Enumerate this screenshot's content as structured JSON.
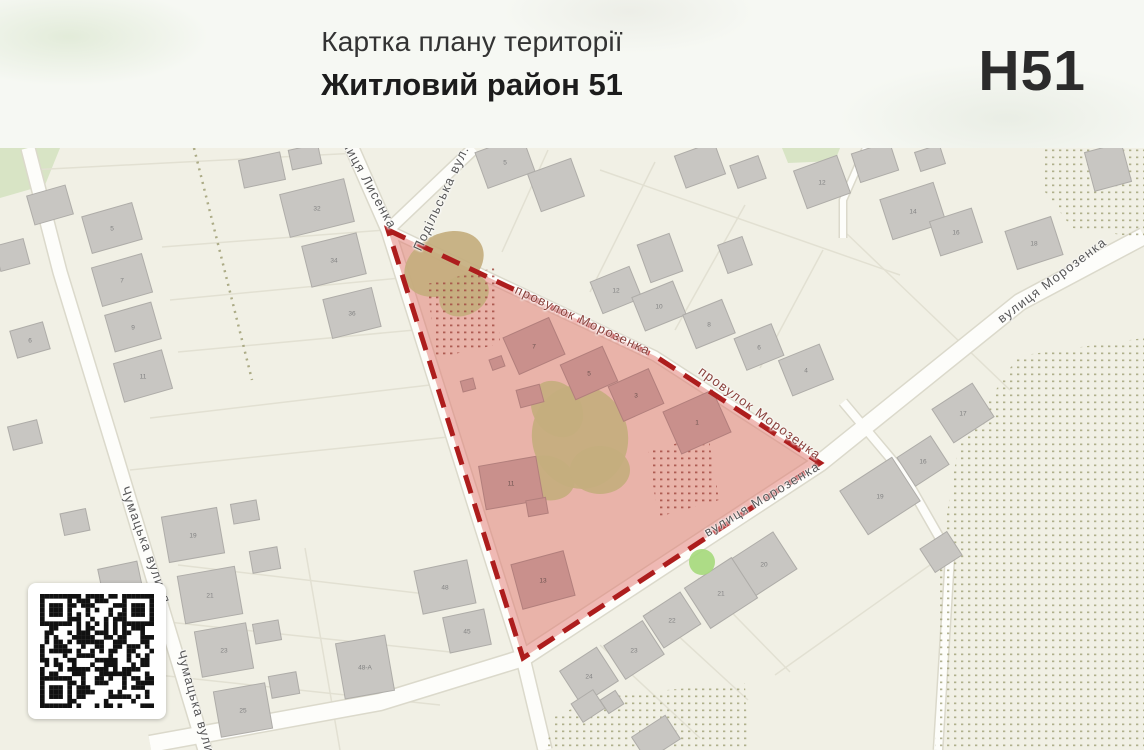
{
  "header": {
    "title": "Картка плану території",
    "subtitle": "Житловий район 51",
    "code": "Н51"
  },
  "colors": {
    "map_bg": "#f1f0e5",
    "green": "#cfe0ba",
    "parcel": "#e2e0d2",
    "road": "#fdfdfa",
    "road_casing": "#dbd9cb",
    "orchard_dot": "#9b9b6f",
    "zone_dot": "#a34c44",
    "building": "#c8c6c2",
    "building_border": "#aeaca8",
    "building_label": "#828282",
    "zone_building": "#c9908c",
    "zone_building_border": "#b27f7c",
    "zone_building_label": "#6e5350",
    "veg": "#c4ae7e",
    "tree": "#a5d97b"
  },
  "map": {
    "streets": [
      {
        "name": "вулиця Лисенка",
        "x": 366,
        "y": 178,
        "rot": 61,
        "red": false
      },
      {
        "name": "Подільська вул.",
        "x": 441,
        "y": 198,
        "rot": -65,
        "red": false
      },
      {
        "name": "провулок Морозенка",
        "x": 583,
        "y": 320,
        "rot": 25,
        "red": true
      },
      {
        "name": "провулок Морозенка",
        "x": 760,
        "y": 413,
        "rot": 36,
        "red": true
      },
      {
        "name": "вулиця Морозенка",
        "x": 1052,
        "y": 280,
        "rot": -37,
        "red": false
      },
      {
        "name": "вулиця Морозенка",
        "x": 762,
        "y": 499,
        "rot": -31,
        "red": false
      },
      {
        "name": "Чумацька вулиця",
        "x": 146,
        "y": 545,
        "rot": 70,
        "red": false
      },
      {
        "name": "Чумацька вулиця",
        "x": 198,
        "y": 710,
        "rot": 74,
        "red": false
      }
    ],
    "roads": [
      {
        "points": [
          [
            28,
            148
          ],
          [
            60,
            272
          ],
          [
            118,
            462
          ],
          [
            205,
            750
          ]
        ],
        "w": 13
      },
      {
        "points": [
          [
            352,
            148
          ],
          [
            388,
            230
          ],
          [
            523,
            658
          ],
          [
            545,
            750
          ]
        ],
        "w": 13
      },
      {
        "points": [
          [
            474,
            148
          ],
          [
            388,
            230
          ]
        ],
        "w": 11
      },
      {
        "points": [
          [
            388,
            230
          ],
          [
            655,
            356
          ],
          [
            820,
            463
          ]
        ],
        "w": 9
      },
      {
        "points": [
          [
            1144,
            236
          ],
          [
            1020,
            302
          ],
          [
            820,
            463
          ],
          [
            523,
            658
          ],
          [
            380,
            702
          ],
          [
            150,
            744
          ]
        ],
        "w": 16
      },
      {
        "points": [
          [
            843,
            402
          ],
          [
            902,
            472
          ],
          [
            950,
            556
          ],
          [
            938,
            750
          ]
        ],
        "w": 8
      },
      {
        "points": [
          [
            866,
            148
          ],
          [
            843,
            200
          ],
          [
            843,
            238
          ]
        ],
        "w": 6
      }
    ],
    "parcel_lines": [
      [
        30,
        170,
        358,
        153
      ],
      [
        162,
        247,
        385,
        230
      ],
      [
        170,
        300,
        400,
        278
      ],
      [
        178,
        352,
        415,
        330
      ],
      [
        150,
        418,
        430,
        385
      ],
      [
        130,
        470,
        448,
        437
      ],
      [
        178,
        565,
        460,
        598
      ],
      [
        168,
        622,
        450,
        652
      ],
      [
        158,
        675,
        440,
        705
      ],
      [
        305,
        548,
        340,
        750
      ],
      [
        502,
        252,
        548,
        150
      ],
      [
        590,
        292,
        655,
        162
      ],
      [
        675,
        330,
        745,
        205
      ],
      [
        760,
        368,
        823,
        250
      ],
      [
        600,
        170,
        900,
        275
      ],
      [
        698,
        578,
        790,
        672
      ],
      [
        650,
        610,
        748,
        700
      ],
      [
        600,
        645,
        700,
        738
      ],
      [
        775,
        675,
        930,
        565
      ],
      [
        845,
        232,
        1010,
        390
      ]
    ],
    "dotted_path": [
      [
        194,
        148
      ],
      [
        252,
        380
      ]
    ],
    "green_areas": [
      [
        [
          0,
          148
        ],
        [
          60,
          148
        ],
        [
          45,
          185
        ],
        [
          0,
          198
        ]
      ],
      [
        [
          782,
          148
        ],
        [
          840,
          148
        ],
        [
          835,
          161
        ],
        [
          788,
          163
        ]
      ]
    ],
    "orchards": [
      [
        [
          1045,
          148
        ],
        [
          1144,
          148
        ],
        [
          1144,
          238
        ],
        [
          1072,
          228
        ],
        [
          1042,
          188
        ]
      ],
      [
        [
          1144,
          338
        ],
        [
          1018,
          356
        ],
        [
          958,
          448
        ],
        [
          940,
          555
        ],
        [
          935,
          750
        ],
        [
          1144,
          750
        ]
      ],
      [
        [
          545,
          750
        ],
        [
          556,
          714
        ],
        [
          622,
          694
        ],
        [
          745,
          683
        ],
        [
          748,
          750
        ]
      ]
    ],
    "zone": {
      "polygon": [
        [
          388,
          230
        ],
        [
          655,
          356
        ],
        [
          820,
          463
        ],
        [
          523,
          658
        ]
      ],
      "fill": "#e2766e",
      "fill_opacity": 0.5,
      "border": "#ad1d1d",
      "dotted_areas": [
        [
          [
            427,
            284
          ],
          [
            494,
            268
          ],
          [
            500,
            344
          ],
          [
            436,
            358
          ]
        ],
        [
          [
            648,
            452
          ],
          [
            708,
            434
          ],
          [
            719,
            500
          ],
          [
            658,
            517
          ]
        ]
      ]
    },
    "vegetation": [
      [
        444,
        264,
        42,
        30,
        -28
      ],
      [
        464,
        295,
        26,
        20,
        -28
      ],
      [
        580,
        437,
        48,
        52,
        -12
      ],
      [
        557,
        409,
        24,
        30,
        -35
      ],
      [
        547,
        478,
        28,
        22,
        15
      ],
      [
        600,
        470,
        30,
        24,
        0
      ]
    ],
    "tree": {
      "x": 702,
      "y": 562,
      "r": 13
    },
    "buildings_zone": [
      [
        534,
        346,
        50,
        40,
        -24,
        "7"
      ],
      [
        589,
        373,
        46,
        38,
        -24,
        "5"
      ],
      [
        636,
        395,
        44,
        38,
        -24,
        "3"
      ],
      [
        697,
        422,
        54,
        46,
        -24,
        "1"
      ],
      [
        511,
        483,
        58,
        44,
        -10,
        "11"
      ],
      [
        537,
        507,
        20,
        16,
        -10,
        ""
      ],
      [
        530,
        396,
        24,
        18,
        -15,
        ""
      ],
      [
        543,
        580,
        54,
        46,
        -15,
        "13"
      ],
      [
        468,
        385,
        13,
        11,
        -15,
        ""
      ],
      [
        497,
        363,
        13,
        11,
        -20,
        ""
      ]
    ],
    "buildings": [
      [
        112,
        228,
        52,
        38,
        -16,
        "5"
      ],
      [
        122,
        280,
        52,
        40,
        -16,
        "7"
      ],
      [
        133,
        327,
        48,
        38,
        -16,
        "9"
      ],
      [
        143,
        376,
        50,
        40,
        -16,
        "11"
      ],
      [
        30,
        340,
        34,
        28,
        -16,
        "6"
      ],
      [
        50,
        205,
        40,
        30,
        -16,
        ""
      ],
      [
        12,
        255,
        30,
        26,
        -15,
        ""
      ],
      [
        25,
        435,
        30,
        24,
        -14,
        ""
      ],
      [
        75,
        522,
        26,
        22,
        -12,
        ""
      ],
      [
        317,
        208,
        66,
        44,
        -14,
        "32"
      ],
      [
        334,
        260,
        56,
        42,
        -14,
        "34"
      ],
      [
        352,
        313,
        50,
        40,
        -14,
        "36"
      ],
      [
        262,
        170,
        42,
        28,
        -12,
        ""
      ],
      [
        305,
        157,
        30,
        20,
        -12,
        ""
      ],
      [
        193,
        535,
        56,
        46,
        -10,
        "19"
      ],
      [
        210,
        595,
        58,
        48,
        -10,
        "21"
      ],
      [
        224,
        650,
        52,
        46,
        -10,
        "23"
      ],
      [
        243,
        710,
        52,
        46,
        -10,
        "25"
      ],
      [
        245,
        512,
        26,
        20,
        -10,
        ""
      ],
      [
        265,
        560,
        28,
        22,
        -10,
        ""
      ],
      [
        267,
        632,
        26,
        20,
        -10,
        ""
      ],
      [
        284,
        685,
        28,
        22,
        -10,
        ""
      ],
      [
        445,
        587,
        54,
        44,
        -12,
        "48"
      ],
      [
        467,
        631,
        42,
        36,
        -12,
        "45"
      ],
      [
        365,
        667,
        50,
        56,
        -10,
        "48-А"
      ],
      [
        120,
        578,
        40,
        26,
        -12,
        ""
      ],
      [
        505,
        162,
        50,
        38,
        -20,
        "5"
      ],
      [
        556,
        185,
        46,
        40,
        -20,
        ""
      ],
      [
        616,
        290,
        42,
        34,
        -22,
        "12"
      ],
      [
        659,
        306,
        44,
        36,
        -22,
        "10"
      ],
      [
        709,
        324,
        42,
        36,
        -22,
        "8"
      ],
      [
        759,
        347,
        40,
        34,
        -22,
        "6"
      ],
      [
        806,
        370,
        44,
        38,
        -22,
        "4"
      ],
      [
        700,
        165,
        42,
        34,
        -20,
        ""
      ],
      [
        748,
        172,
        30,
        24,
        -20,
        ""
      ],
      [
        822,
        182,
        46,
        40,
        -20,
        "12"
      ],
      [
        660,
        258,
        34,
        40,
        -20,
        ""
      ],
      [
        735,
        255,
        26,
        30,
        -20,
        ""
      ],
      [
        913,
        211,
        56,
        42,
        -18,
        "14"
      ],
      [
        956,
        232,
        44,
        36,
        -18,
        "16"
      ],
      [
        1034,
        243,
        48,
        40,
        -18,
        "18"
      ],
      [
        875,
        162,
        40,
        30,
        -18,
        ""
      ],
      [
        930,
        158,
        26,
        20,
        -18,
        ""
      ],
      [
        1108,
        167,
        38,
        40,
        -15,
        ""
      ],
      [
        963,
        413,
        48,
        40,
        -33,
        "17"
      ],
      [
        923,
        461,
        40,
        34,
        -33,
        "16"
      ],
      [
        880,
        496,
        62,
        52,
        -33,
        "19"
      ],
      [
        941,
        552,
        32,
        28,
        -33,
        ""
      ],
      [
        764,
        564,
        50,
        44,
        -33,
        "20"
      ],
      [
        721,
        593,
        56,
        48,
        -33,
        "21"
      ],
      [
        672,
        620,
        44,
        38,
        -33,
        "22"
      ],
      [
        634,
        650,
        46,
        40,
        -33,
        "23"
      ],
      [
        589,
        676,
        44,
        40,
        -33,
        "24"
      ],
      [
        588,
        706,
        26,
        22,
        -33,
        ""
      ],
      [
        612,
        702,
        18,
        16,
        -33,
        ""
      ],
      [
        656,
        738,
        40,
        28,
        -33,
        ""
      ]
    ],
    "qr": {
      "modules": 25,
      "seed": 9
    }
  }
}
